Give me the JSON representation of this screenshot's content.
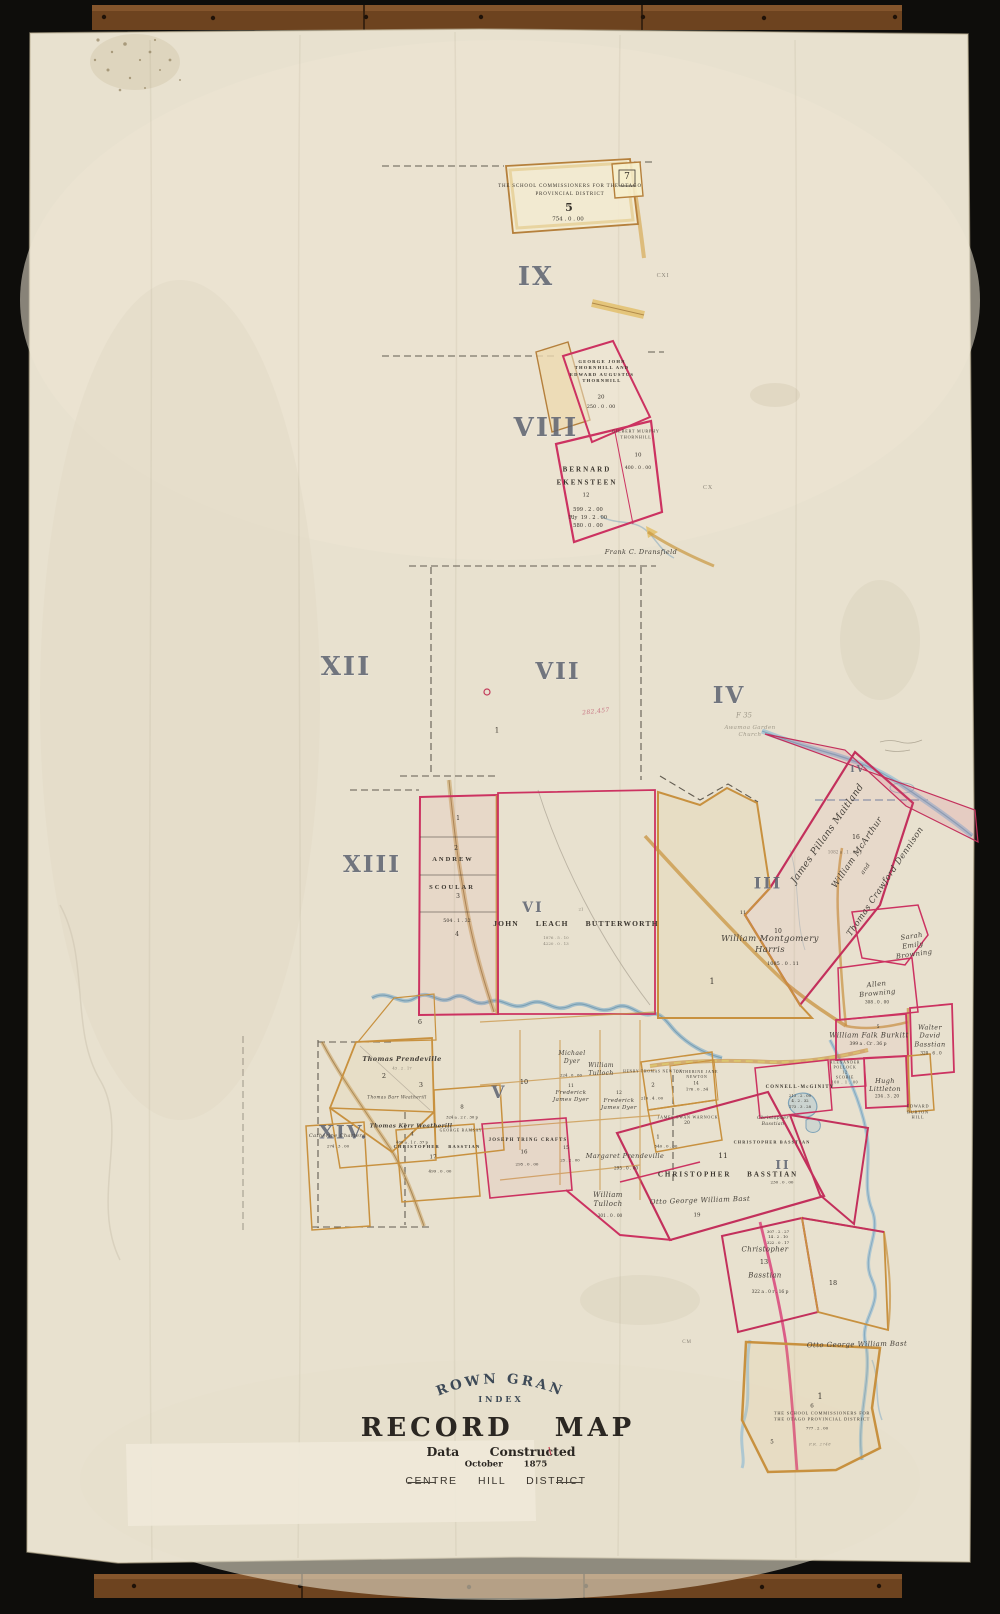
{
  "title_block": {
    "arc_title": "CROWN GRANT",
    "index_label": "INDEX",
    "main_title": "RECORD MAP",
    "data_line": "Data Constructed",
    "date_line": "October 1875",
    "district_line": "CENTRE HILL DISTRICT"
  },
  "regions": {
    "ix": "IX",
    "viii": "VIII",
    "xii": "XII",
    "vii": "VII",
    "iv": "IV",
    "xiii": "XIII",
    "vi": "VI",
    "iii": "III",
    "xiv": "XIV.",
    "v": "V",
    "ii": "II",
    "iv_small": "IV"
  },
  "edge_marks": {
    "cxi": "CXI",
    "cx": "CX",
    "cm": "CM"
  },
  "notes": {
    "rednote": "282,457",
    "pencil_ref": "F 35",
    "pencil_note": "Awamoa Garden\nChurch"
  },
  "parcels": {
    "school_top": {
      "name": "THE SCHOOL COMMISSIONERS FOR THE OTAGO\nPROVINCIAL DISTRICT",
      "number": "5",
      "area": "754 . 0 . 00",
      "neighbor_number": "7"
    },
    "thornhill": {
      "name": "GEORGE JOHN\nTHORNHILL AND\nEDWARD AUGUSTUS\nTHORNHILL",
      "number": "20",
      "area": "250 . 0 . 00"
    },
    "thornhill_gilbert": {
      "name": "GILBERT MURPHY\nTHORNHILL",
      "number": "10",
      "area": "400 . 0 . 00"
    },
    "ekensteen": {
      "name": "BERNARD\nEKENSTEEN",
      "number": "12",
      "areas": "599 . 2 . 00\nRly  19 . 2 . 00\n580 . 0 . 00"
    },
    "dransfield": {
      "name": "Frank C. Dransfield"
    },
    "vii_block": {
      "number": "1"
    },
    "scoular": {
      "first_name": "ANDREW",
      "last_name": "SCOULAR",
      "n1": "1",
      "n2": "2",
      "n3": "3",
      "n4": "4",
      "area": "504 . 1 . 32"
    },
    "butterworth": {
      "name": "JOHN LEACH BUTTERWORTH",
      "sub": "21",
      "areas": "1876 . 5 . 10\n4220 . 0 . 13"
    },
    "harris": {
      "name": "William Montgomery\nHarris",
      "number": "10",
      "sub": "11",
      "area": "1085 . 0 . 11",
      "south_number": "1"
    },
    "maitland": {
      "name": "James Pillans Maitland",
      "number": "16",
      "area": "1082 a . 1 . 05 p"
    },
    "mcarthur": {
      "name": "William McArthur",
      "and_word": "and"
    },
    "dennison": {
      "name": "Thomas Crawford Dennison"
    },
    "browning_sarah": {
      "name": "Sarah\nEmily\nBrowning"
    },
    "browning_allen": {
      "name": "Allen\nBrowning",
      "area": "308 . 0 . 00"
    },
    "burkitt": {
      "name": "William Falk Burkitt",
      "number": "5",
      "area": "399 a . Cr . 36 p"
    },
    "bastian_walter": {
      "name": "Walter\nDavid\nBasstian",
      "area": "320 . 6 . 0"
    },
    "pollock": {
      "name": "ALEXANDER\nPOLLOCK\n12\nSCOBIE\n100 . 1 . 00"
    },
    "littleton": {
      "name": "Hugh\nLittleton",
      "area": "234 . 3 . 20"
    },
    "hill_edward": {
      "name": "EDWARD\nBURTON\nHILL"
    },
    "connell": {
      "name": "CONNELL-McGINITY",
      "areas": "213 . 2 . 00\n4 . 2 . 32\n173 . 3 . 28"
    },
    "newton_henry": {
      "name": "HENRY THOMAS NEWTON",
      "number": "2",
      "area": "210 . 4 . 00"
    },
    "newton_catherine": {
      "name": "CATHERINE JANE\nNEWTON",
      "number": "14",
      "area": "176 . 0 . 34"
    },
    "warnock": {
      "name": "JAMES SWAN WARNOCK",
      "number": "20",
      "sub_number": "1",
      "area": "540 . 0 . 00"
    },
    "basstian_main": {
      "number": "11",
      "name": "CHRISTOPHER BASSTIAN"
    },
    "basstian_right": {
      "name": "CHRISTOPHER BASSTIAN",
      "area": "230 . 0 . 00"
    },
    "basstian_small": {
      "name": "Christopher\nBasstian"
    },
    "prendeville_margaret": {
      "name": "Margaret Prendeville",
      "area": "295 . 0 . 00"
    },
    "tulloch_south": {
      "name": "William\nTulloch",
      "area": "301 . 0 . 00"
    },
    "bast_otto_mid": {
      "name": "Otto George William Bast",
      "number": "19"
    },
    "basstian_13": {
      "first_name": "Christopher",
      "number": "13",
      "last_name": "Basstian",
      "area": "322 a . 0 r . 16 p",
      "calc": "307 . 2 . 27\n14 . 2 . 10\n322 . 0 . 17",
      "neighbor_number": "18"
    },
    "bast_otto_se": {
      "name": "Otto George William Bast"
    },
    "school_bottom": {
      "number": "1",
      "sub": "6",
      "name": "THE SCHOOL COMMISSIONERS FOR\nTHE OTAGO PROVINCIAL DISTRICT",
      "area": "777 . 2 . 00",
      "note": "P.R. 2748",
      "n5": "5"
    },
    "charters": {
      "name": "Catherine Charters",
      "area": "274 . 3 . 00"
    },
    "basstian_17": {
      "name": "CHRISTOPHER BASSTIAN",
      "number": "17",
      "area": "499 . 0 . 00"
    },
    "crafts": {
      "name": "JOSEPH TRING CRAFTS",
      "number": "16",
      "area": "295 . 0 . 00",
      "n15": "15",
      "area15": "25 . 2 . 00"
    },
    "prendeville_thomas": {
      "name": "Thomas Prendeville",
      "area": "43 . 2 . 17",
      "n2": "2",
      "n3": "3",
      "n6": "6"
    },
    "ramsay": {
      "name": "GEORGE RAMSAY",
      "number": "8",
      "area": "324 a . 2 r . 30 p"
    },
    "weatherill_barr": {
      "name": "Thomas Barr Weatherill"
    },
    "weatherill_kerr": {
      "name": "Thomas Kerr Weatherill",
      "number": "4",
      "area": "400 a . 1 r . 37 p"
    },
    "dyer_michael": {
      "name": "Michael\nDyer",
      "area": "224 . 0 . 00"
    },
    "tulloch_mid": {
      "name": "William\nTulloch"
    },
    "dyer_frederick_1": {
      "name": "Frederick\nJames Dyer",
      "number": "11"
    },
    "dyer_frederick_2": {
      "name": "Frederick\nJames Dyer",
      "number": "12"
    },
    "v_block": {
      "number": "10"
    }
  }
}
